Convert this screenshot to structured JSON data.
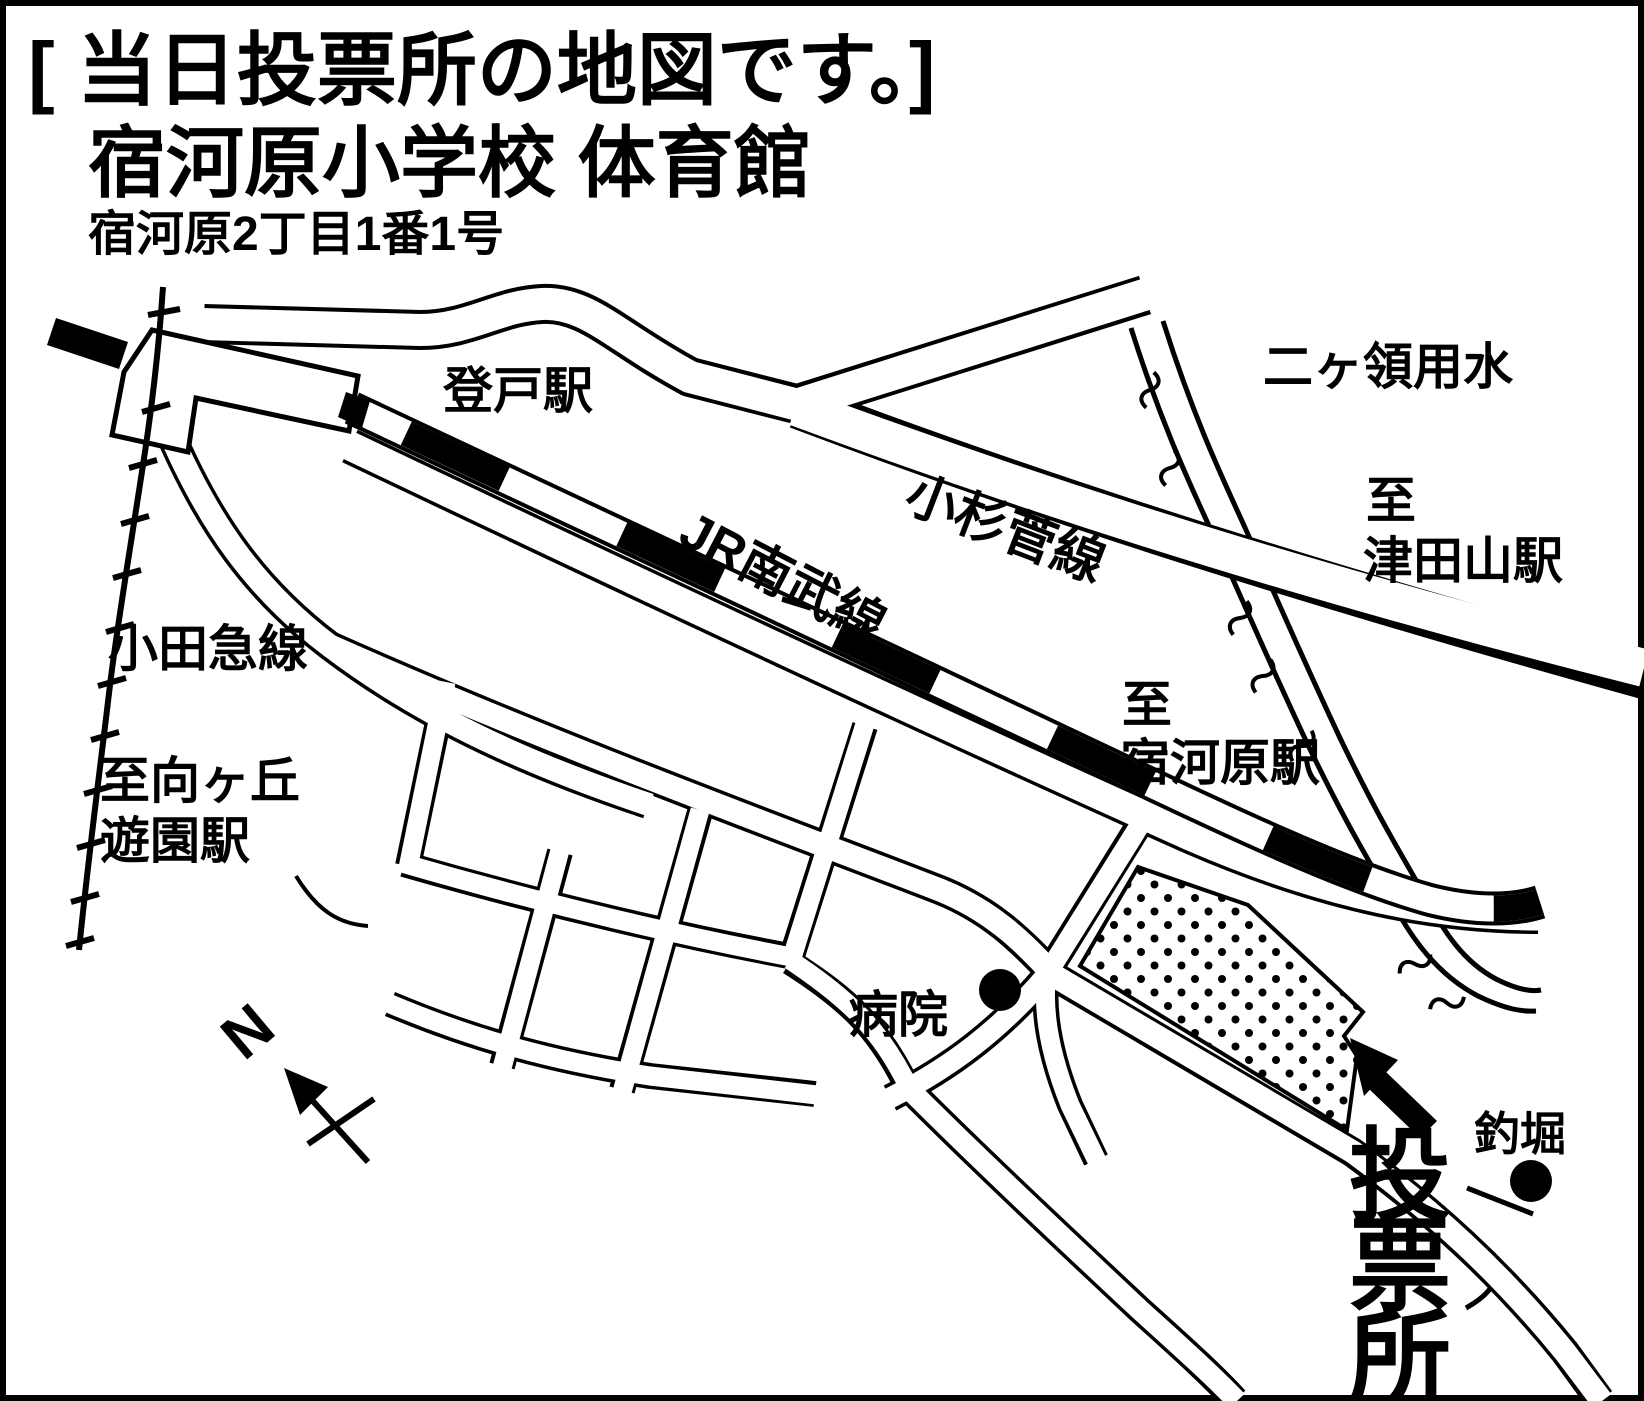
{
  "title": {
    "line1": "[ 当日投票所の地図です。]",
    "line2": "宿河原小学校 体育館",
    "line3": "宿河原2丁目1番1号"
  },
  "map": {
    "labels": {
      "noborito_station": "登戸駅",
      "jr_nambu_line": "JR南武線",
      "odakyu_line": "小田急線",
      "kosuge_road": "小杉菅線",
      "nikaryo_canal": "二ヶ領用水",
      "to_prefix_tsudayama": "至",
      "tsudayama_station": "津田山駅",
      "to_prefix_shukugawara": "至",
      "shukugawara_station": "宿河原駅",
      "to_mukogaoka_line1": "至向ヶ丘",
      "to_mukogaoka_line2": "遊園駅",
      "hospital": "病院",
      "fishing_pond": "釣堀",
      "north": "N"
    },
    "polling_station": {
      "label": "投票所",
      "chars": [
        "投",
        "票",
        "所"
      ]
    }
  },
  "colors": {
    "ink": "#000000",
    "paper": "#ffffff"
  }
}
